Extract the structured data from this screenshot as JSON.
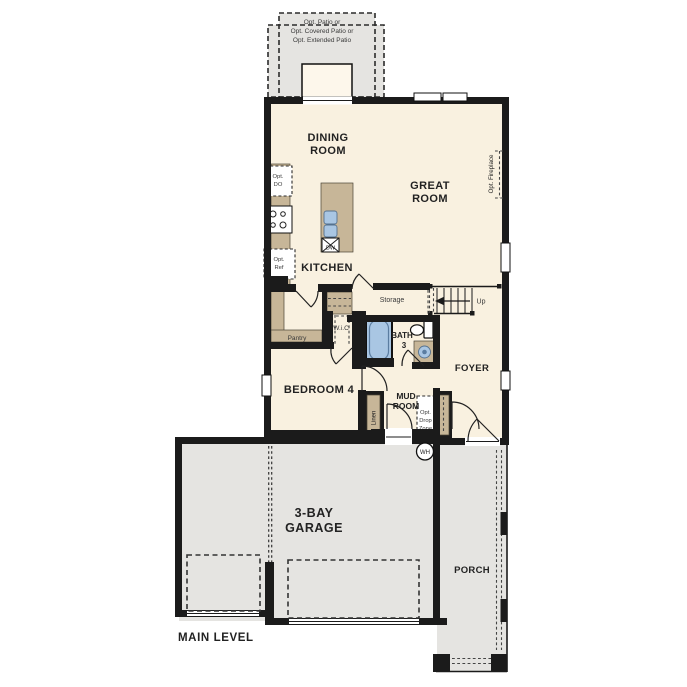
{
  "colors": {
    "wall": "#1b1b1b",
    "floor": "#f9f1e0",
    "slab": "#e5e4e1",
    "cabinet": "#c7b698",
    "fixture": "#a9c6e3",
    "text_dark": "#222222",
    "text_soft": "#3a3a3a"
  },
  "plan": {
    "level_title": "MAIN LEVEL",
    "options": {
      "patio_line1": "Opt. Patio or",
      "patio_line2": "Opt. Covered Patio or",
      "patio_line3": "Opt. Extended Patio",
      "fireplace": "Opt. Fireplace",
      "double_oven_line1": "Opt.",
      "double_oven_line2": "DO",
      "fridge_line1": "Opt.",
      "fridge_line2": "Ref",
      "drop_zone_line1": "Opt.",
      "drop_zone_line2": "Drop",
      "drop_zone_line3": "Zone"
    },
    "rooms": {
      "dining_line1": "DINING",
      "dining_line2": "ROOM",
      "great_line1": "GREAT",
      "great_line2": "ROOM",
      "kitchen": "KITCHEN",
      "bath_line1": "BATH",
      "bath_line2": "3",
      "bedroom4": "BEDROOM 4",
      "mud_line1": "MUD",
      "mud_line2": "ROOM",
      "foyer": "FOYER",
      "garage_line1": "3-BAY",
      "garage_line2": "GARAGE",
      "porch": "PORCH",
      "pantry": "Pantry",
      "wic": "W.i.C",
      "storage": "Storage",
      "linen": "Linen"
    },
    "fixtures": {
      "dishwasher": "DW",
      "water_heater": "WH"
    },
    "stairs": {
      "up": "Up"
    }
  }
}
